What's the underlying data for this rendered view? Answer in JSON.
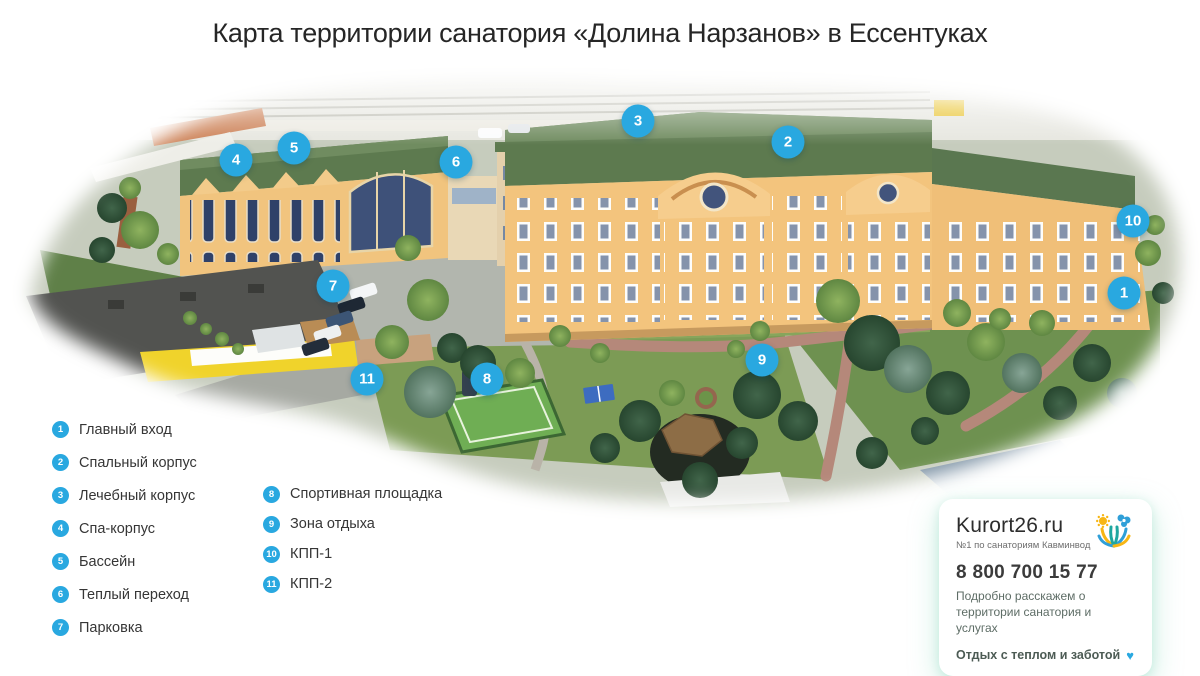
{
  "title": "Карта территории санатория «Долина Нарзанов» в Ессентуках",
  "legend": {
    "items": [
      {
        "number": "1",
        "label": "Главный вход"
      },
      {
        "number": "2",
        "label": "Спальный корпус"
      },
      {
        "number": "3",
        "label": "Лечебный корпус"
      },
      {
        "number": "4",
        "label": "Спа-корпус"
      },
      {
        "number": "5",
        "label": "Бассейн"
      },
      {
        "number": "6",
        "label": "Теплый переход"
      },
      {
        "number": "7",
        "label": "Парковка"
      },
      {
        "number": "8",
        "label": "Спортивная площадка"
      },
      {
        "number": "9",
        "label": "Зона отдыха"
      },
      {
        "number": "10",
        "label": "КПП-1"
      },
      {
        "number": "11",
        "label": "КПП-2"
      }
    ]
  },
  "infocard": {
    "brand": "Kurort26.ru",
    "tagline": "№1 по санаториям Кавминвод",
    "phone": "8 800 700 15 77",
    "description": "Подробно расскажем о территории санатория и услугах",
    "slogan": "Отдых с теплом и заботой",
    "heart": "♥"
  },
  "colors": {
    "marker_blue": "#29a8e0",
    "heart_blue": "#29a8e0",
    "roof_green": "#5d7a4f",
    "facade_orange": "#f3c47d"
  }
}
